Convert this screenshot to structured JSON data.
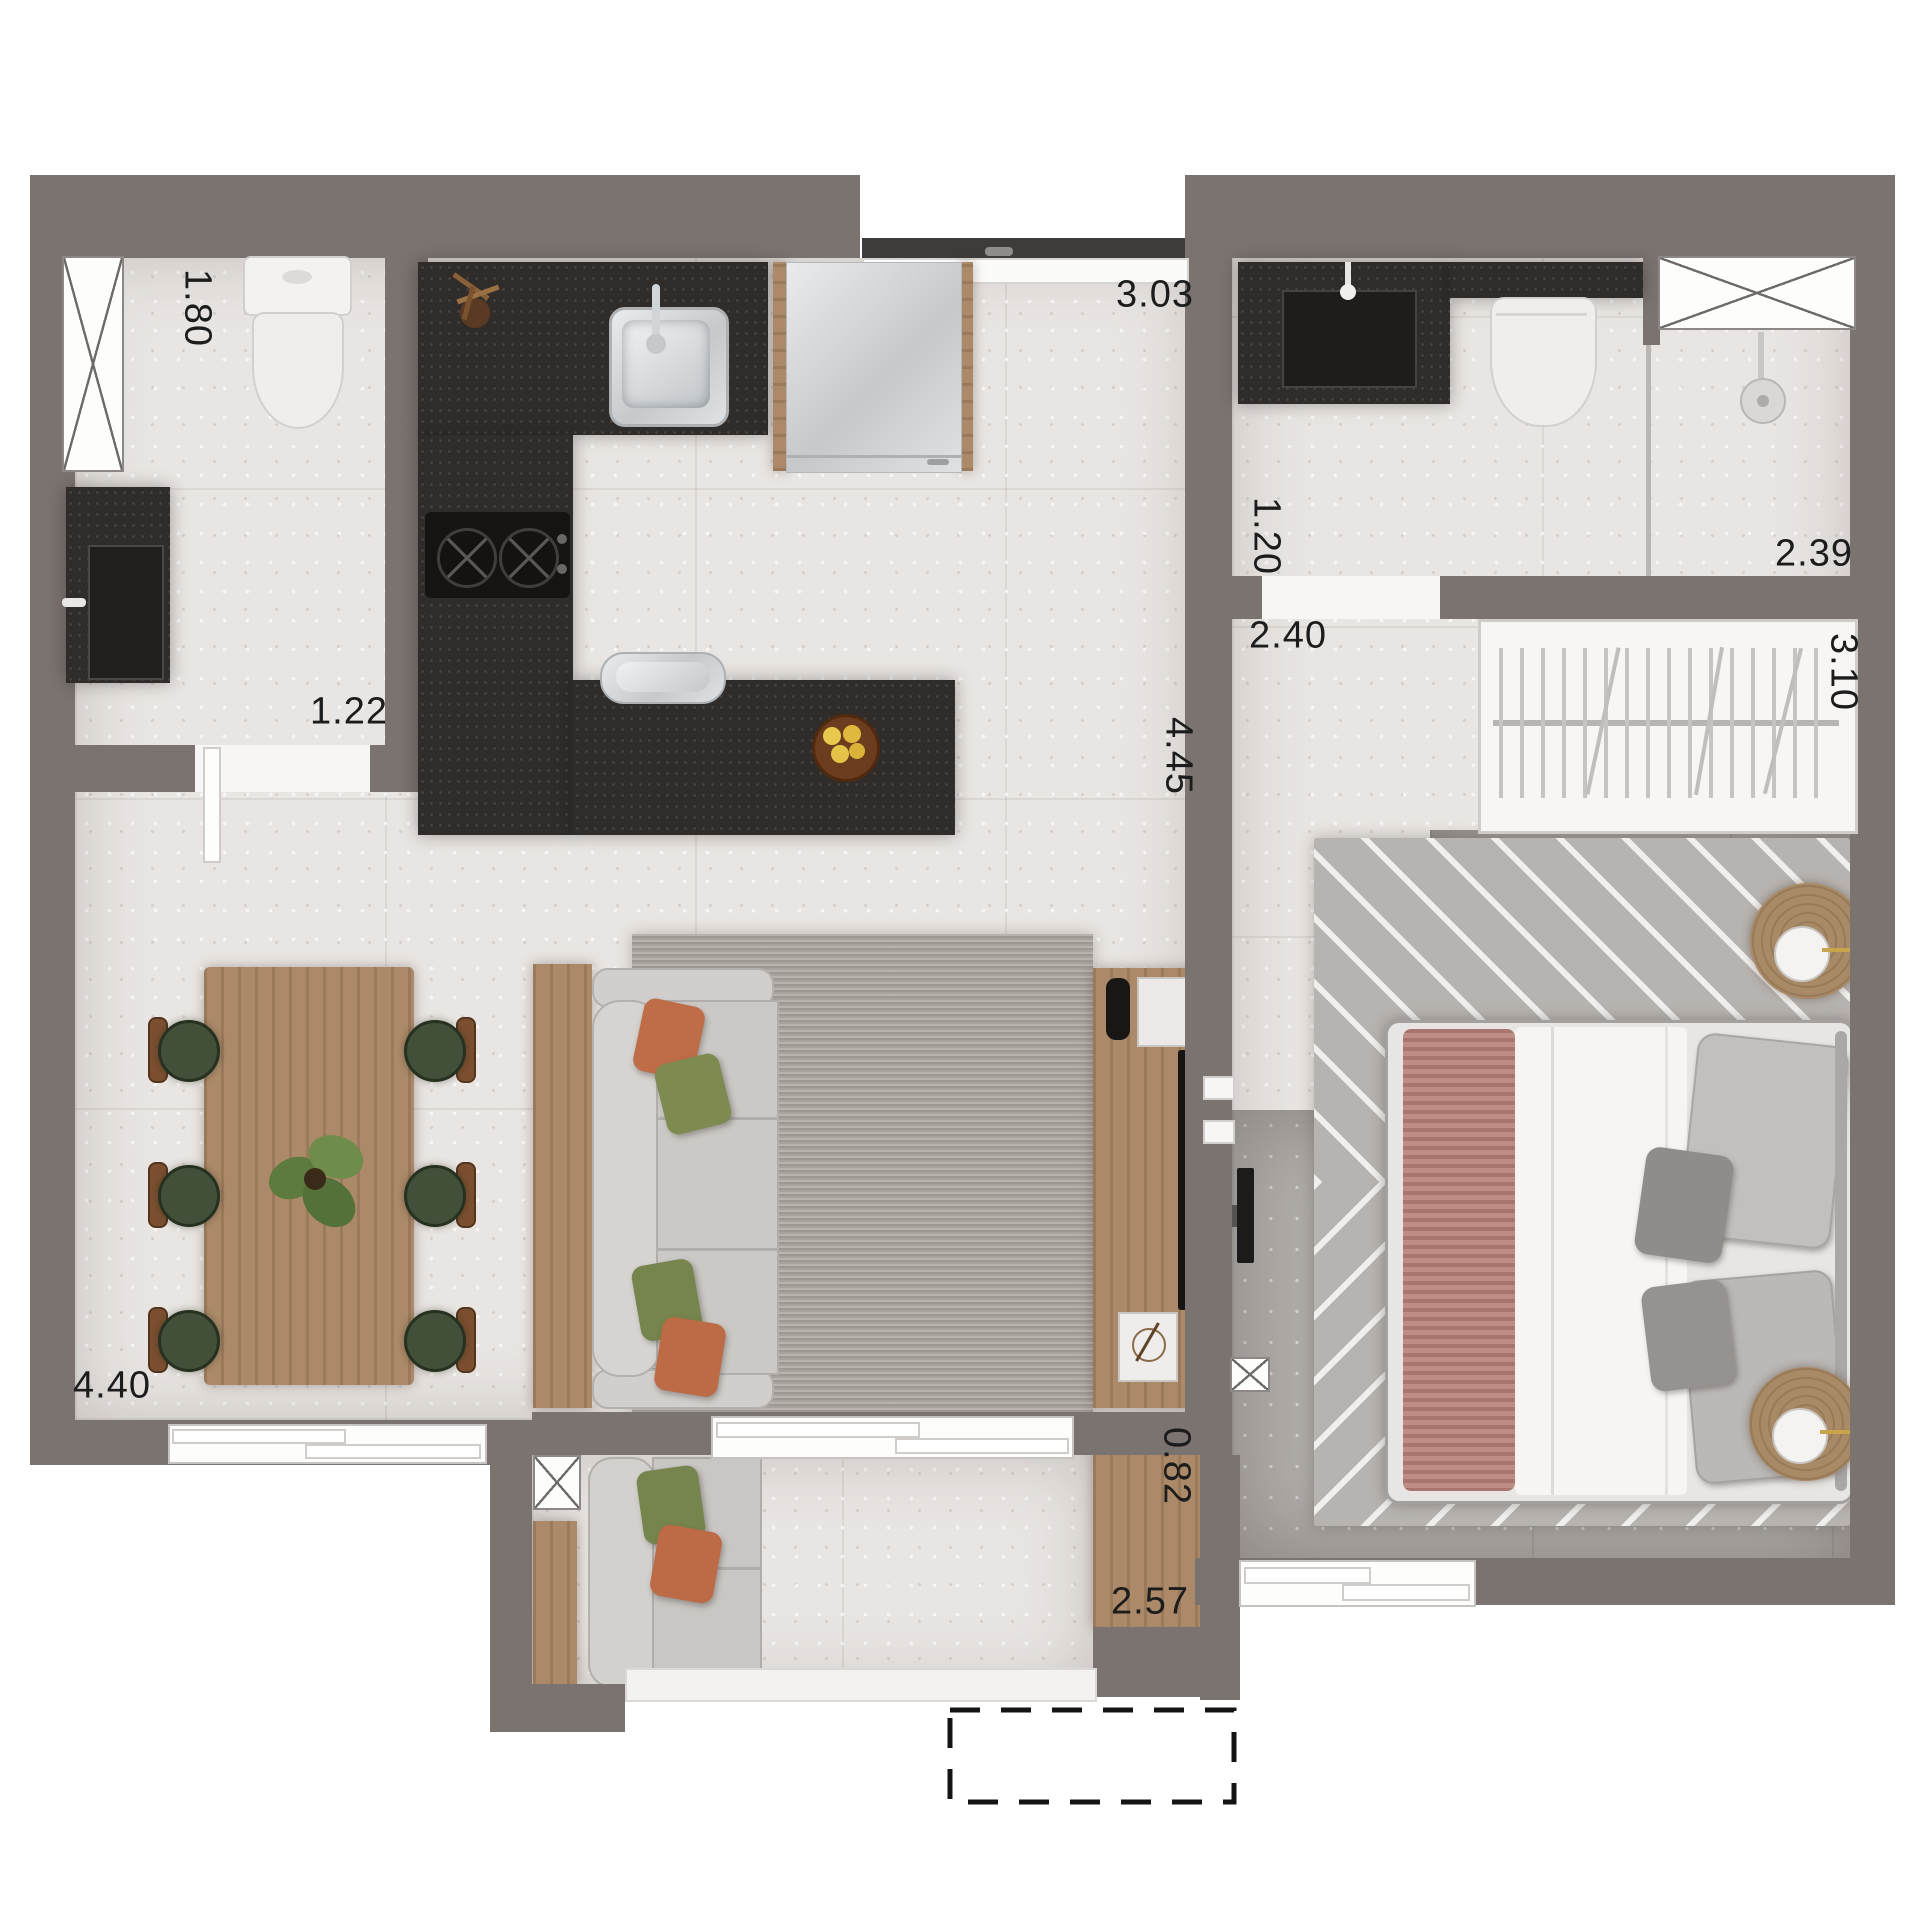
{
  "labels": {
    "bath1_length": "1.80",
    "bath1_width": "1.22",
    "kitchen_width": "3.03",
    "living_length": "4.45",
    "bath2_width": "1.20",
    "hall_width": "2.40",
    "shower_width": "2.39",
    "wardrobe_length": "3.10",
    "living_width": "4.40",
    "balcony_deck_depth": "0.82",
    "balcony_length": "2.57"
  },
  "colors": {
    "wall": "#7b7370",
    "floor_light": "#e9e5e2",
    "floor_bedroom": "#b1adaa",
    "counter_dark": "#2f2c2a",
    "wood": "#ac8a69",
    "rug_living": "#a8a29d",
    "rug_bedroom": "#b7b3b0",
    "sofa_fabric": "#cbc8c5",
    "pillow_orange": "#bf6c49",
    "pillow_green": "#7a8750",
    "chair_green": "#42503a",
    "bed_duvet": "#f6f5f3",
    "bed_runner_pink": "#c08d84",
    "appliance_steel": "#d6d9db",
    "appliance_black": "#161514",
    "label_text": "#1c1c1c",
    "exterior": "#ffffff"
  }
}
